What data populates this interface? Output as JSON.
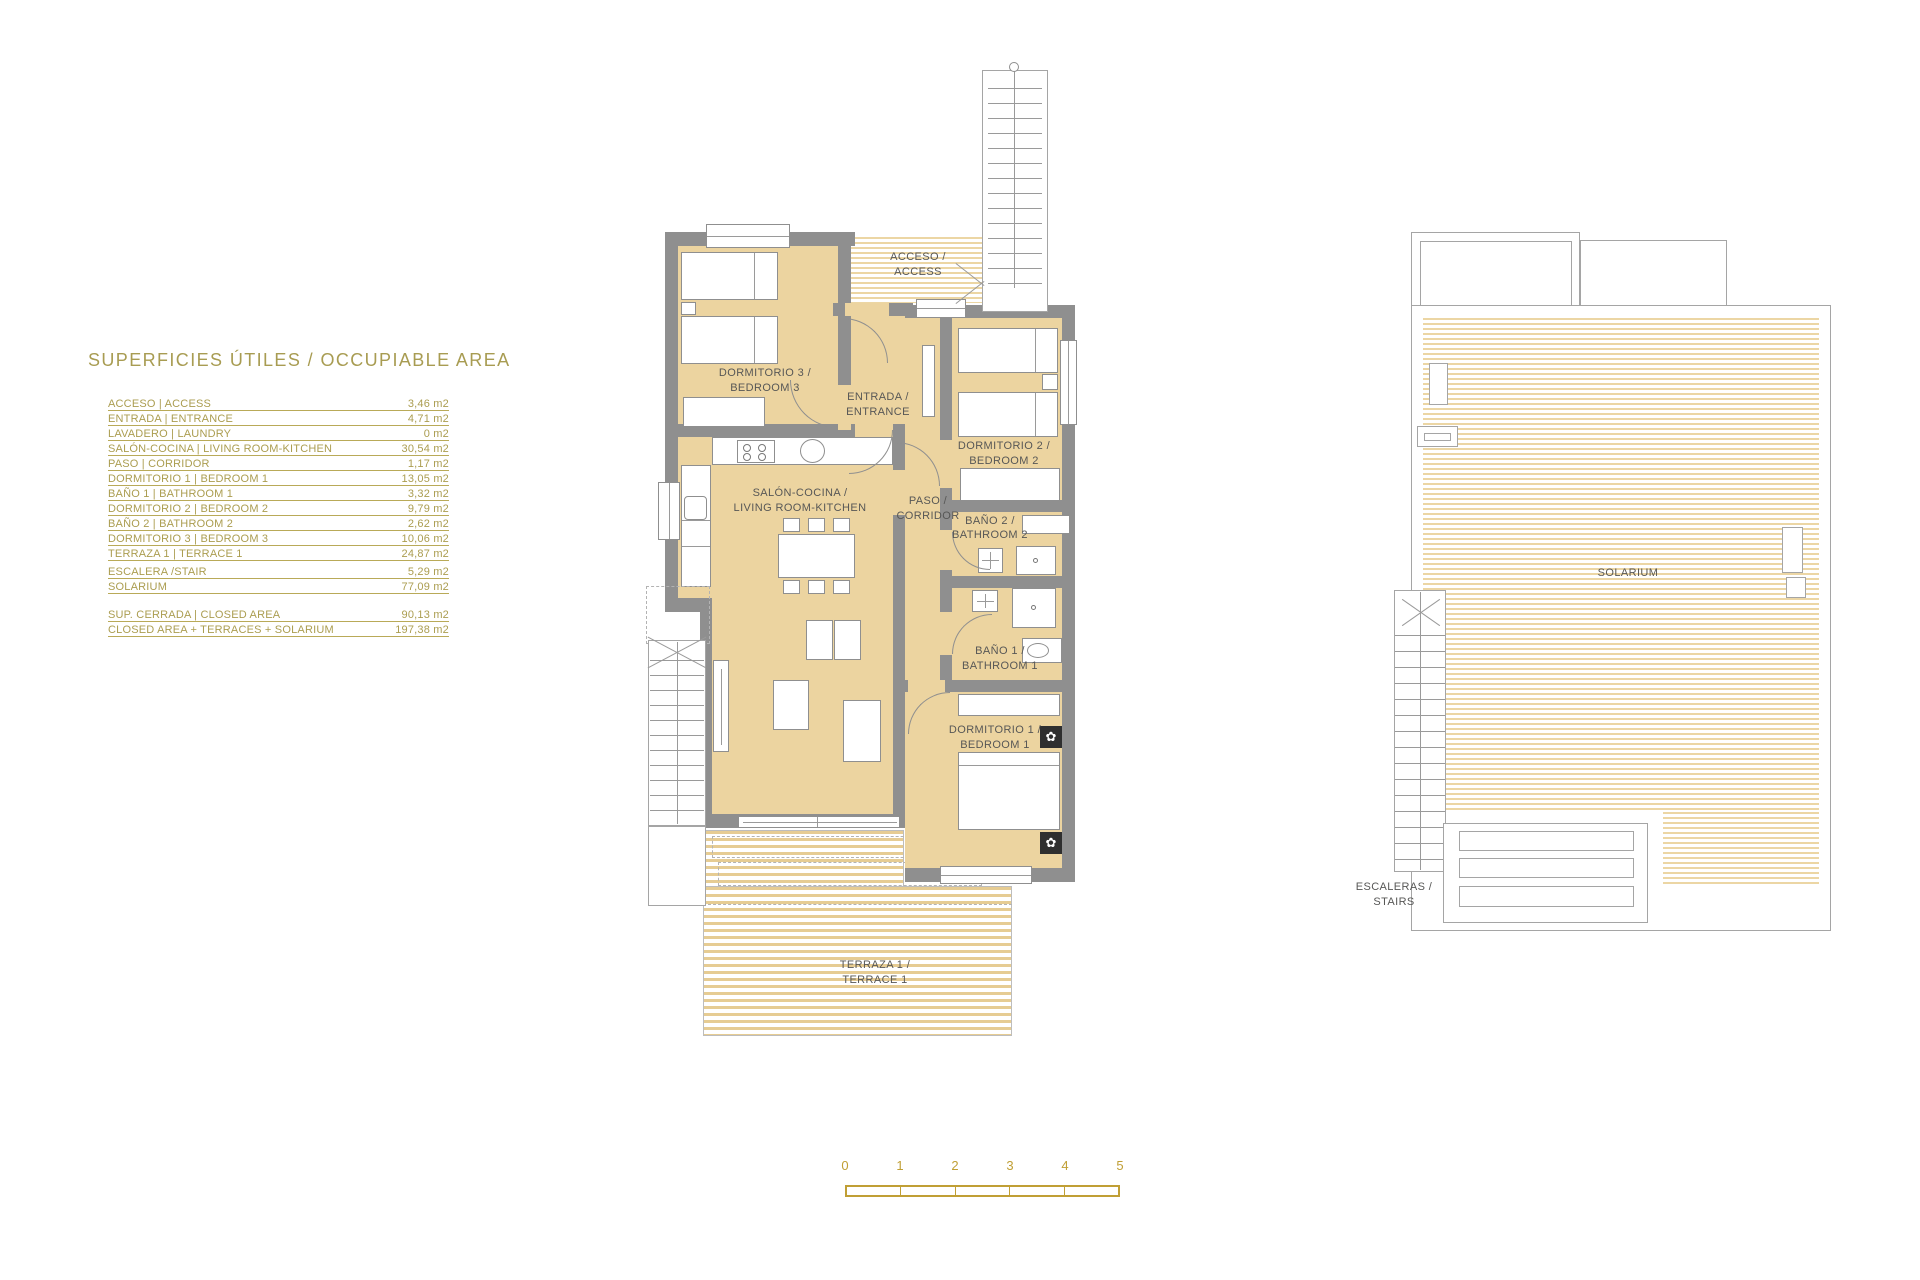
{
  "title": "SUPERFICIES ÚTILES / OCCUPIABLE AREA",
  "area_table": {
    "rows": [
      {
        "label": "ACCESO | ACCESS",
        "value": "3,46 m2"
      },
      {
        "label": "ENTRADA | ENTRANCE",
        "value": "4,71 m2"
      },
      {
        "label": "LAVADERO | LAUNDRY",
        "value": "0 m2"
      },
      {
        "label": "SALÓN-COCINA | LIVING ROOM-KITCHEN",
        "value": "30,54 m2"
      },
      {
        "label": "PASO | CORRIDOR",
        "value": "1,17 m2"
      },
      {
        "label": "DORMITORIO 1 | BEDROOM 1",
        "value": "13,05 m2"
      },
      {
        "label": "BAÑO 1 | BATHROOM 1",
        "value": "3,32 m2"
      },
      {
        "label": "DORMITORIO 2 | BEDROOM 2",
        "value": "9,79 m2"
      },
      {
        "label": "BAÑO 2 | BATHROOM 2",
        "value": "2,62 m2"
      },
      {
        "label": "DORMITORIO 3 | BEDROOM 3",
        "value": "10,06 m2"
      },
      {
        "label": "TERRAZA 1 | TERRACE 1",
        "value": "24,87 m2"
      }
    ],
    "stair_rows": [
      {
        "label": "ESCALERA /STAIR",
        "value": "5,29 m2"
      },
      {
        "label": "SOLARIUM",
        "value": "77,09 m2"
      }
    ],
    "summary_rows": [
      {
        "label": "SUP. CERRADA | CLOSED AREA",
        "value": "90,13 m2"
      },
      {
        "label": "CLOSED AREA + TERRACES + SOLARIUM",
        "value": "197,38 m2"
      }
    ]
  },
  "ground_floor": {
    "acceso": {
      "line1": "ACCESO /",
      "line2": "ACCESS"
    },
    "entrada": {
      "line1": "ENTRADA /",
      "line2": "ENTRANCE"
    },
    "dormitorio3": {
      "line1": "DORMITORIO 3 /",
      "line2": "BEDROOM 3"
    },
    "salon": {
      "line1": "SALÓN-COCINA /",
      "line2": "LIVING ROOM-KITCHEN"
    },
    "paso": {
      "line1": "PASO /",
      "line2": "CORRIDOR"
    },
    "dormitorio2": {
      "line1": "DORMITORIO 2 /",
      "line2": "BEDROOM 2"
    },
    "bano2": {
      "line1": "BAÑO 2 /",
      "line2": "BATHROOM 2"
    },
    "bano1": {
      "line1": "BAÑO 1 /",
      "line2": "BATHROOM 1"
    },
    "dormitorio1": {
      "line1": "DORMITORIO 1 /",
      "line2": "BEDROOM 1"
    },
    "terraza": {
      "line1": "TERRAZA 1 /",
      "line2": "TERRACE 1"
    }
  },
  "roof_plan": {
    "solarium_label": "SOLARIUM",
    "escaleras": {
      "line1": "ESCALERAS /",
      "line2": "STAIRS"
    }
  },
  "scale_bar": {
    "ticks": [
      "0",
      "1",
      "2",
      "3",
      "4",
      "5"
    ]
  },
  "icons": {
    "plant": "✿"
  },
  "colors": {
    "gold": "#ab9d50",
    "scale_gold": "#c09f35",
    "tan": "#ecd4a0",
    "wall_gray": "#8f8f8f",
    "label_gray": "#575756"
  }
}
